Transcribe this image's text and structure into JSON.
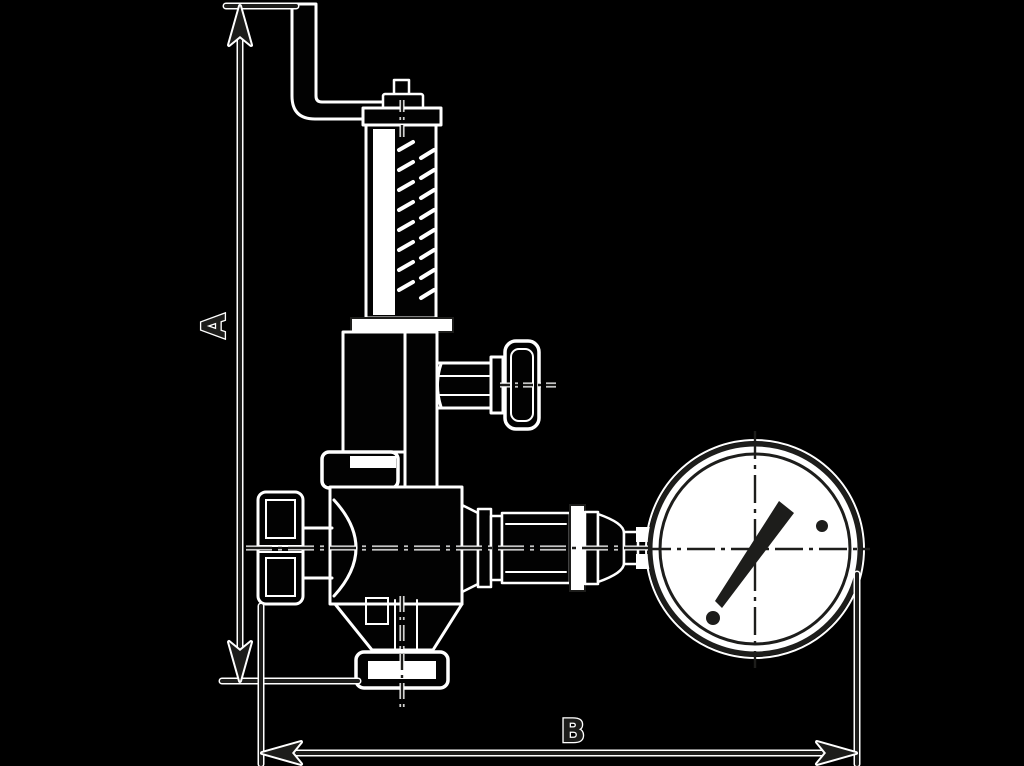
{
  "figure": {
    "title": "Safety relief valve with test lever and pressure gauge — dimensional outline drawing",
    "dimension_labels": {
      "height": "A",
      "width": "B"
    }
  },
  "colors": {
    "background": "#000000",
    "ink": "#1d1d1b",
    "paper": "#ffffff"
  }
}
